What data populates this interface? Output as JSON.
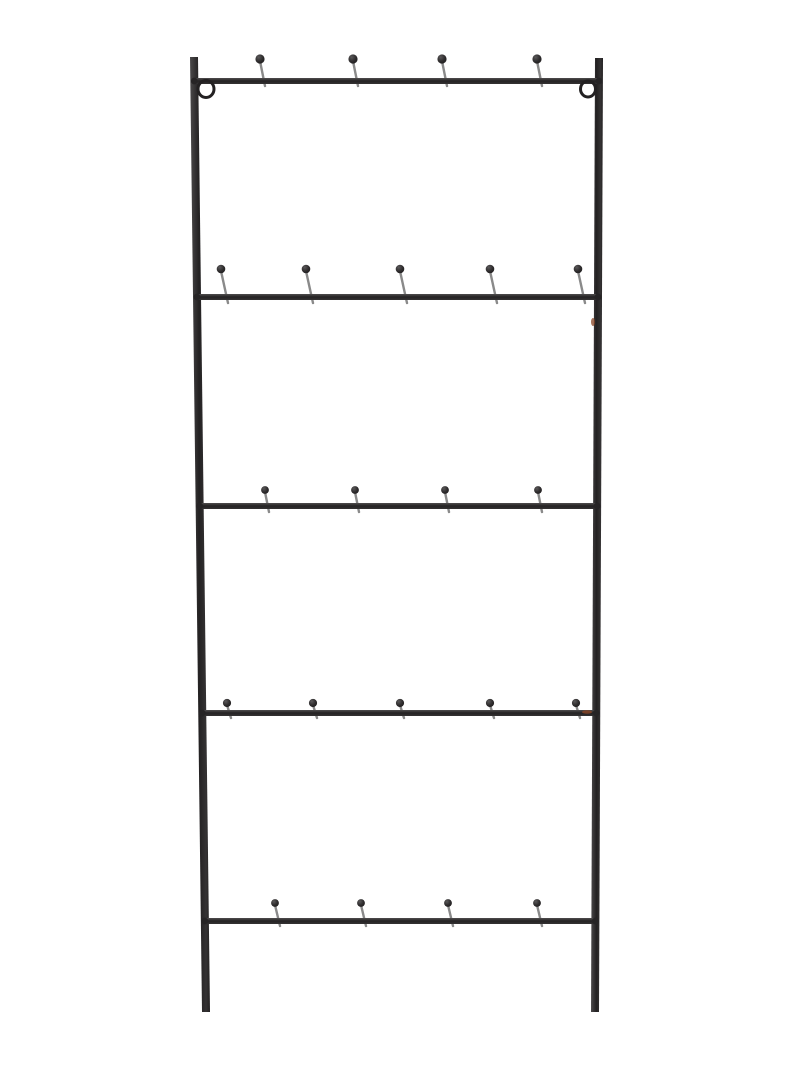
{
  "page": {
    "background_color": "#ffffff"
  },
  "product": {
    "name": "black-metal-ladder-hook-rack",
    "kind": "Wall-mounted black metal ladder rack with ball-tip hooks and hanging rings",
    "colors": {
      "background": "#ffffff",
      "frame_light": "#4b494a",
      "frame_dark": "#232122",
      "frame_mid": "#343233",
      "bar_light": "#4f4d4e",
      "bar_dark": "#242223",
      "ball_highlight": "#5a5859",
      "ball_mid": "#2e2c2d",
      "ball_dark": "#1d1b1c",
      "hook_stem": "#8a8a8a",
      "weld": "#262425",
      "rust_accent": "#8a4526"
    },
    "frame": {
      "left_rail": {
        "x_top": 194,
        "x_bottom": 206,
        "y_top": 57,
        "y_bottom": 1012,
        "width": 8
      },
      "right_rail": {
        "x_top": 599,
        "x_bottom": 595,
        "y_top": 58,
        "y_bottom": 1012,
        "width": 8
      },
      "bar_thickness": 6
    },
    "hang_rings": [
      {
        "cx": 206,
        "cy": 89,
        "rx": 8,
        "ry": 8.5,
        "stroke_width": 3
      },
      {
        "cx": 588,
        "cy": 89,
        "rx": 7.5,
        "ry": 8,
        "stroke_width": 3
      }
    ],
    "bars": [
      {
        "y": 81,
        "hook_xs": [
          260,
          353,
          442,
          537
        ],
        "hook_height": 22,
        "hook_lean": 5,
        "hook_tail": 5,
        "ball_r": 4.6
      },
      {
        "y": 297,
        "hook_xs": [
          221,
          306,
          400,
          490,
          578
        ],
        "hook_height": 28,
        "hook_lean": 7,
        "hook_tail": 6,
        "ball_r": 4.3
      },
      {
        "y": 506,
        "hook_xs": [
          265,
          355,
          445,
          538
        ],
        "hook_height": 16,
        "hook_lean": 4,
        "hook_tail": 6,
        "ball_r": 3.9
      },
      {
        "y": 713,
        "hook_xs": [
          227,
          313,
          400,
          490,
          576
        ],
        "hook_height": 10,
        "hook_lean": 4,
        "hook_tail": 5,
        "ball_r": 4.1
      },
      {
        "y": 921,
        "hook_xs": [
          275,
          361,
          448,
          537
        ],
        "hook_height": 18,
        "hook_lean": 5,
        "hook_tail": 5,
        "ball_r": 3.9
      }
    ],
    "rust_marks": [
      {
        "cx": 593,
        "cy": 322,
        "rx": 2,
        "ry": 4,
        "opacity": 0.75
      },
      {
        "cx": 587,
        "cy": 712,
        "rx": 5,
        "ry": 1.8,
        "opacity": 0.8
      }
    ],
    "stem_width": 2.4
  }
}
